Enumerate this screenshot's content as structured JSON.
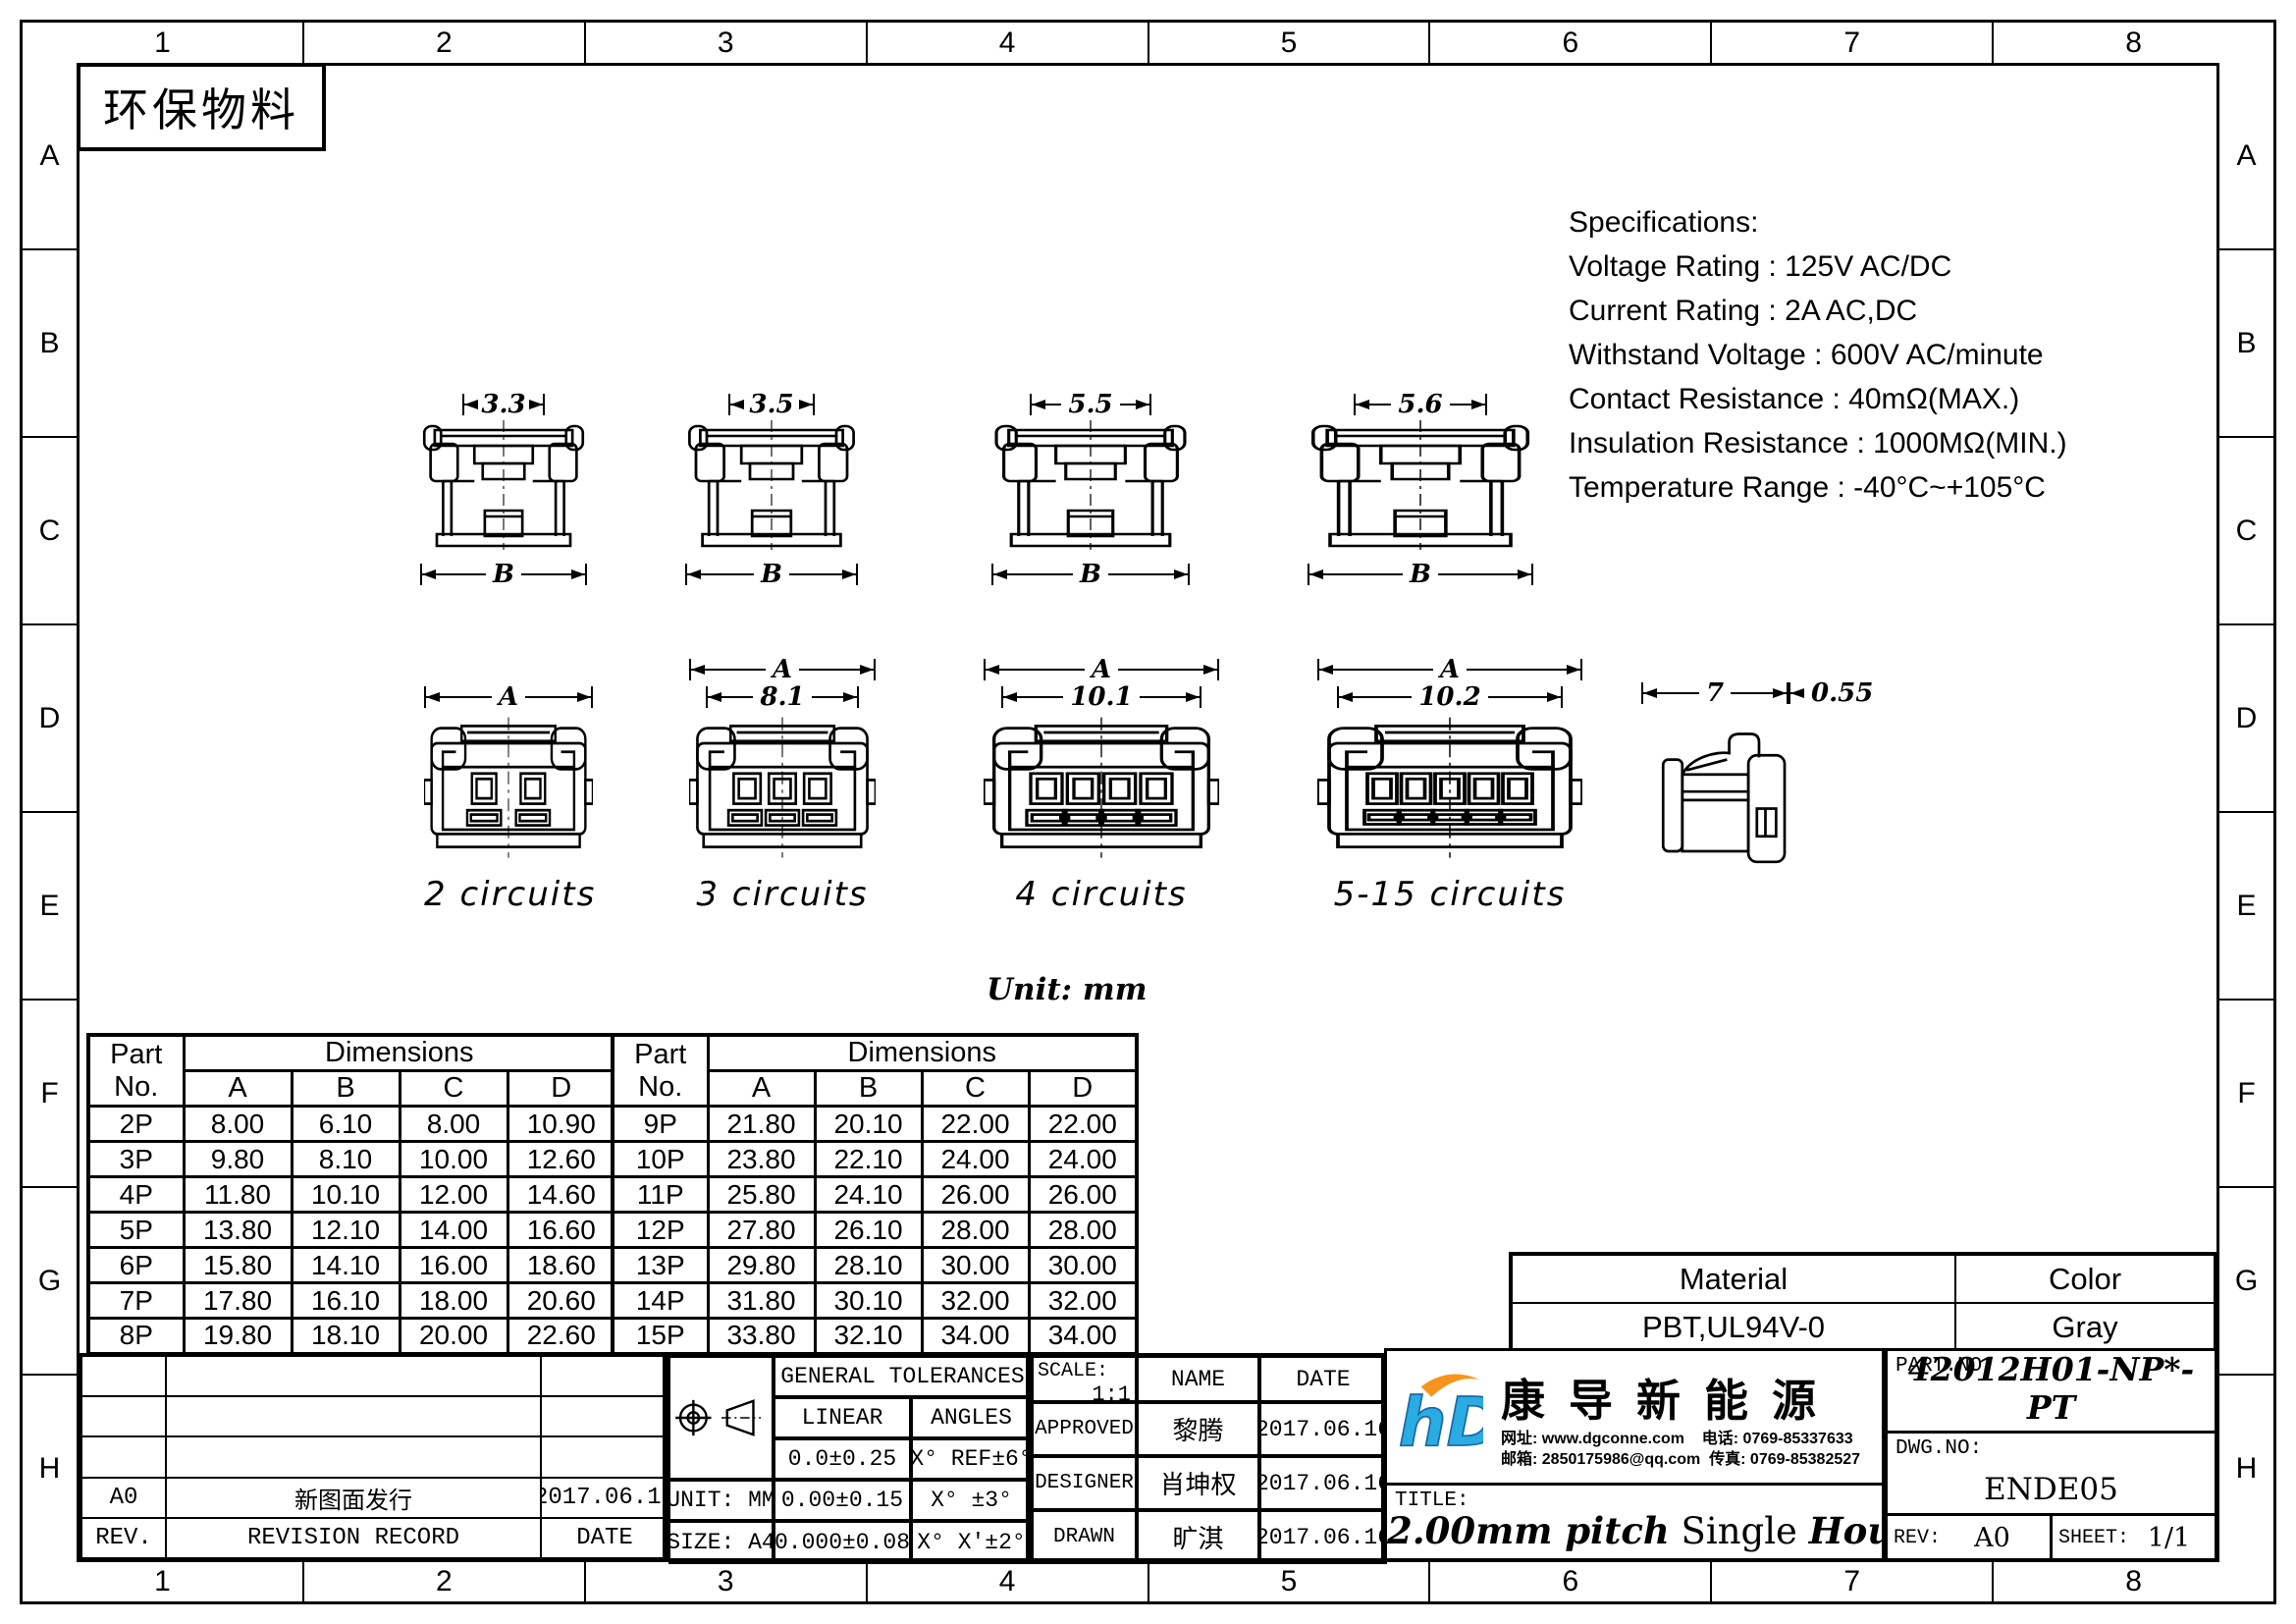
{
  "eco_label": "环保物料",
  "unit_note": "Unit: mm",
  "zones": {
    "cols": [
      "1",
      "2",
      "3",
      "4",
      "5",
      "6",
      "7",
      "8"
    ],
    "rows": [
      "A",
      "B",
      "C",
      "D",
      "E",
      "F",
      "G",
      "H"
    ]
  },
  "specs": {
    "title": "Specifications:",
    "lines": [
      "Voltage Rating : 125V AC/DC",
      "Current Rating : 2A AC,DC",
      "Withstand Voltage : 600V AC/minute",
      "Contact Resistance : 40mΩ(MAX.)",
      "Insulation Resistance : 1000MΩ(MIN.)",
      "Temperature Range : -40°C~+105°C"
    ]
  },
  "views": {
    "top": [
      {
        "dim": "3.3",
        "base": "B"
      },
      {
        "dim": "3.5",
        "base": "B"
      },
      {
        "dim": "5.5",
        "base": "B"
      },
      {
        "dim": "5.6",
        "base": "B"
      }
    ],
    "front": [
      {
        "top": "A",
        "caption": "2 circuits"
      },
      {
        "top": "A",
        "inner": "8.1",
        "caption": "3 circuits"
      },
      {
        "top": "A",
        "inner": "10.1",
        "caption": "4 circuits"
      },
      {
        "top": "A",
        "inner": "10.2",
        "caption": "5-15 circuits"
      }
    ],
    "side": {
      "width": "7",
      "wall": "0.55"
    }
  },
  "dim_table": {
    "part_header": "Part",
    "no_header": "No.",
    "dims_header": "Dimensions",
    "cols": [
      "A",
      "B",
      "C",
      "D"
    ],
    "left_rows": [
      [
        "2P",
        "8.00",
        "6.10",
        "8.00",
        "10.90"
      ],
      [
        "3P",
        "9.80",
        "8.10",
        "10.00",
        "12.60"
      ],
      [
        "4P",
        "11.80",
        "10.10",
        "12.00",
        "14.60"
      ],
      [
        "5P",
        "13.80",
        "12.10",
        "14.00",
        "16.60"
      ],
      [
        "6P",
        "15.80",
        "14.10",
        "16.00",
        "18.60"
      ],
      [
        "7P",
        "17.80",
        "16.10",
        "18.00",
        "20.60"
      ],
      [
        "8P",
        "19.80",
        "18.10",
        "20.00",
        "22.60"
      ]
    ],
    "right_rows": [
      [
        "9P",
        "21.80",
        "20.10",
        "22.00",
        "22.00"
      ],
      [
        "10P",
        "23.80",
        "22.10",
        "24.00",
        "24.00"
      ],
      [
        "11P",
        "25.80",
        "24.10",
        "26.00",
        "26.00"
      ],
      [
        "12P",
        "27.80",
        "26.10",
        "28.00",
        "28.00"
      ],
      [
        "13P",
        "29.80",
        "28.10",
        "30.00",
        "30.00"
      ],
      [
        "14P",
        "31.80",
        "30.10",
        "32.00",
        "32.00"
      ],
      [
        "15P",
        "33.80",
        "32.10",
        "34.00",
        "34.00"
      ]
    ]
  },
  "material_block": {
    "material_label": "Material",
    "color_label": "Color",
    "material": "PBT,UL94V-0",
    "color": "Gray"
  },
  "revision": {
    "entry_rev": "A0",
    "entry_desc": "新图面发行",
    "entry_date": "2017.06.16",
    "rev_footer": "REV.",
    "record_footer": "REVISION RECORD",
    "date_footer": "DATE"
  },
  "tolerances": {
    "header": "GENERAL TOLERANCES",
    "linear": "LINEAR",
    "angles": "ANGLES",
    "unit": "UNIT: MM",
    "size": "SIZE: A4",
    "linear_rows": [
      "0.0±0.25",
      "0.00±0.15",
      "0.000±0.08"
    ],
    "angle_rows": [
      "X° REF±6°",
      "X° ±3°",
      "X° X'±2°"
    ]
  },
  "approval": {
    "scale_label": "SCALE:",
    "scale": "1:1",
    "name_header": "NAME",
    "date_header": "DATE",
    "rows": [
      [
        "APPROVED",
        "黎腾",
        "2017.06.16"
      ],
      [
        "DESIGNER",
        "肖坤权",
        "2017.06.16"
      ],
      [
        "DRAWN",
        "旷淇",
        "2017.06.16"
      ]
    ]
  },
  "company": {
    "logo": "hD",
    "name": "康导新能源",
    "website": "网址: www.dgconne.com",
    "phone": "电话: 0769-85337633",
    "email": "邮箱: 2850175986@qq.com",
    "fax": "传真: 0769-85382527"
  },
  "title_block": {
    "title_label": "TITLE:",
    "title_p1": "2.00mm pitch",
    "title_p2": "Single",
    "title_p3": "Housing",
    "part_label": "PART.NO:",
    "part_no": "42012H01-NP*-PT",
    "dwg_label": "DWG.NO:",
    "dwg_no": "ENDE05",
    "rev_label": "REV:",
    "rev": "A0",
    "sheet_label": "SHEET:",
    "sheet": "1/1"
  },
  "colors": {
    "logo_blue": "#2aace3",
    "logo_orange": "#f7941e",
    "line_black": "#000000"
  }
}
